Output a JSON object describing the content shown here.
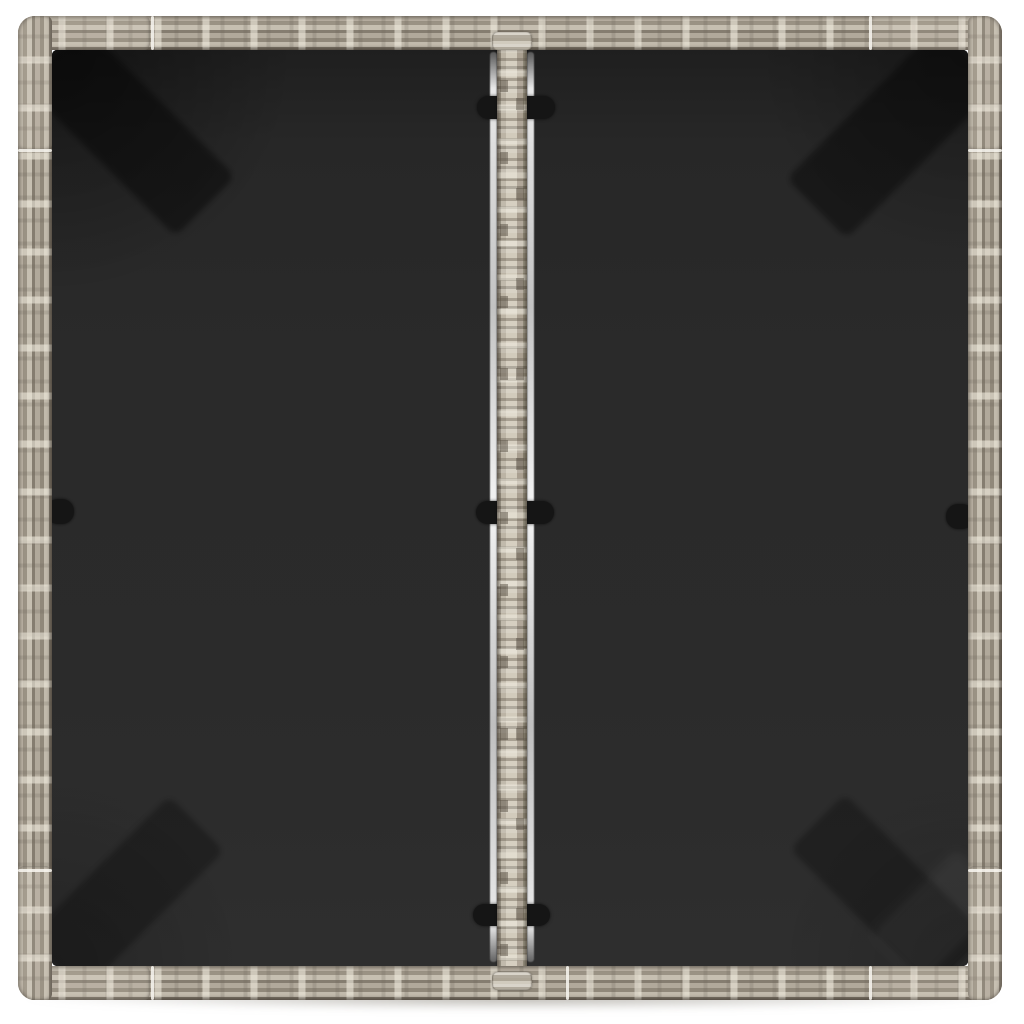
{
  "scene": {
    "subject": "Top-down product photo of a square grey poly-rattan garden table with a two-panel black glass top",
    "background": "plain white studio background"
  },
  "palette": {
    "background": "#ffffff",
    "rattanBase": "#a89f90",
    "rattanLight": "#d6cfc0",
    "rattanMid": "#b6aea0",
    "rattanDark": "#7d7568",
    "cornerBlock": "#bcb4a5",
    "glassTop": "#1f1f1f",
    "glassBase": "#2b2b2b",
    "glassBottom": "#2e2e2e",
    "legShadow": "#0a0a0a",
    "clip": "#151515",
    "glint": "#f6f4ef",
    "dropShadow": "#7a7468"
  },
  "structure": {
    "frame_rails": [
      "top",
      "right",
      "bottom",
      "left"
    ],
    "corner_blocks": [
      "top-left",
      "top-right",
      "bottom-left",
      "bottom-right"
    ],
    "frame_seams": 9,
    "glass_panels": [
      "left",
      "right"
    ],
    "center_divider": "woven rattan strip between the two glass panels",
    "glass_glints": [
      "left-of-strip",
      "right-of-strip"
    ],
    "clips": {
      "on_strip": [
        "top",
        "middle",
        "bottom"
      ],
      "on_edges": [
        "left-frame",
        "right-frame"
      ]
    },
    "leg_shadows": [
      "top-left",
      "top-right",
      "bottom-left",
      "bottom-right"
    ]
  }
}
